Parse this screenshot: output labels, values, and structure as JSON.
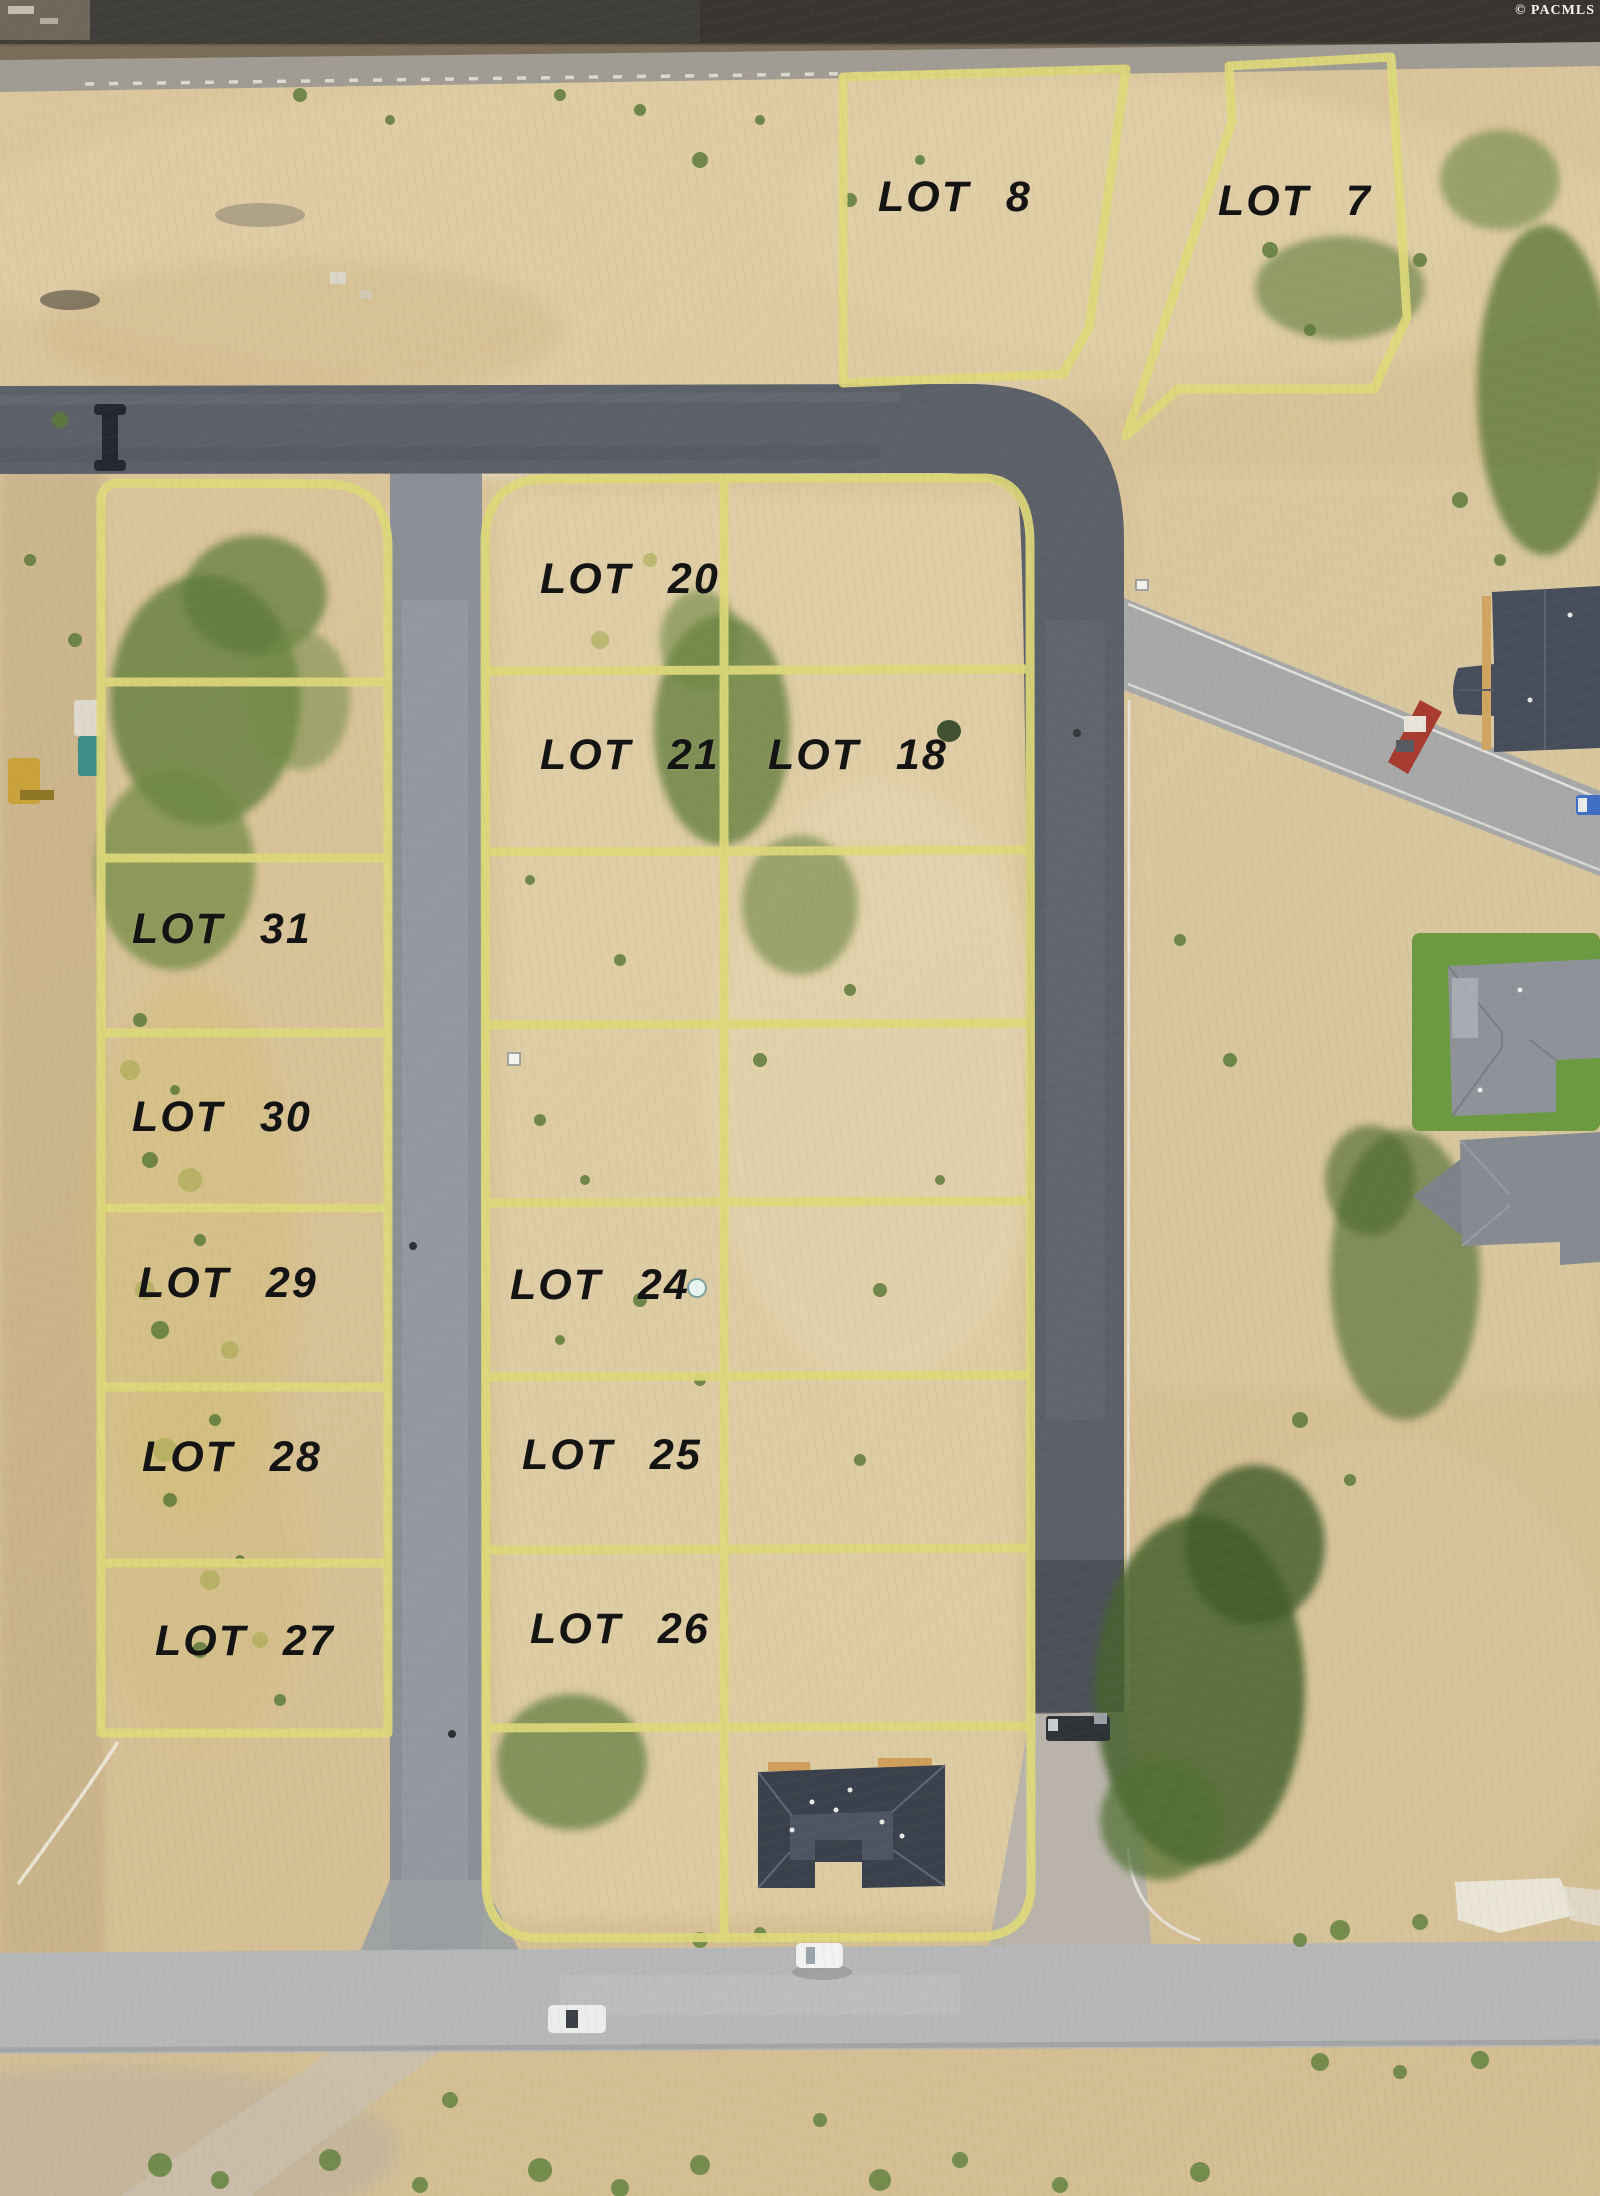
{
  "watermark": "© PACMLS",
  "lots": [
    {
      "id": "lot-8",
      "label": "LOT 8"
    },
    {
      "id": "lot-7",
      "label": "LOT 7"
    },
    {
      "id": "lot-20",
      "label": "LOT 20"
    },
    {
      "id": "lot-21",
      "label": "LOT 21"
    },
    {
      "id": "lot-18",
      "label": "LOT 18"
    },
    {
      "id": "lot-31",
      "label": "LOT 31"
    },
    {
      "id": "lot-30",
      "label": "LOT 30"
    },
    {
      "id": "lot-29",
      "label": "LOT 29"
    },
    {
      "id": "lot-24",
      "label": "LOT 24"
    },
    {
      "id": "lot-28",
      "label": "LOT 28"
    },
    {
      "id": "lot-25",
      "label": "LOT 25"
    },
    {
      "id": "lot-27",
      "label": "LOT 27"
    },
    {
      "id": "lot-26",
      "label": "LOT 26"
    }
  ],
  "colors": {
    "lot_boundary": "#ded97a",
    "asphalt_dark": "#5b6069",
    "road_light": "#b6b7b9",
    "terrain_tan": "#d7c29a",
    "roof_dark": "#3a414c",
    "lawn_green": "#6b9a40"
  }
}
